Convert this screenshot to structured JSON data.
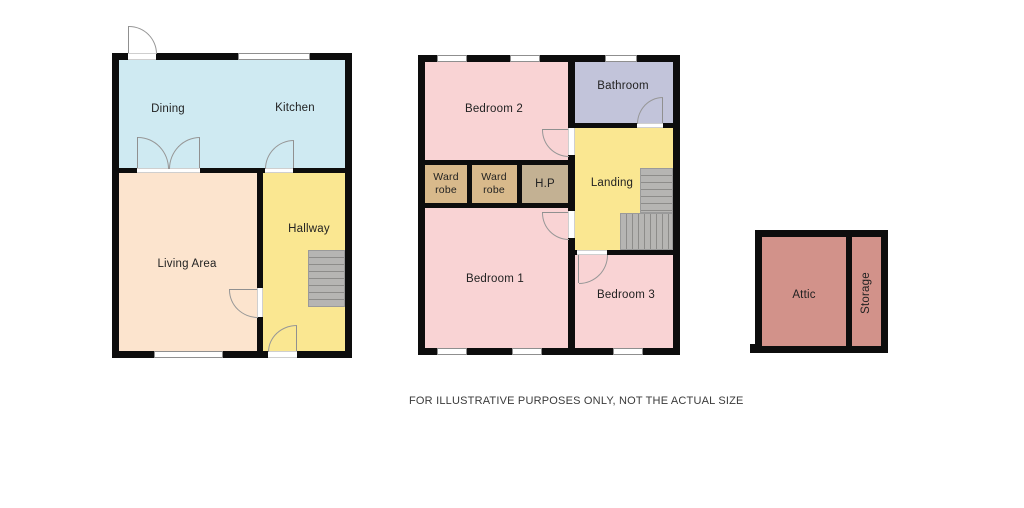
{
  "disclaimer": "FOR ILLUSTRATIVE PURPOSES ONLY, NOT THE ACTUAL SIZE",
  "colors": {
    "wall": "#0d0d0d",
    "dining_kitchen": "#cfeaf2",
    "living": "#fce4ce",
    "hallway": "#fae791",
    "bedroom": "#f9d3d4",
    "bathroom": "#c2c4da",
    "wardrobe": "#d8b98b",
    "hp": "#c3b193",
    "attic": "#d2928a"
  },
  "floors": {
    "ground": {
      "rooms": {
        "dining": "Dining",
        "kitchen": "Kitchen",
        "living": "Living Area",
        "hallway": "Hallway"
      }
    },
    "first": {
      "rooms": {
        "bedroom2": "Bedroom 2",
        "bathroom": "Bathroom",
        "wardrobe1": "Ward robe",
        "wardrobe2": "Ward robe",
        "hp": "H.P",
        "landing": "Landing",
        "bedroom1": "Bedroom 1",
        "bedroom3": "Bedroom 3"
      }
    },
    "attic": {
      "rooms": {
        "attic": "Attic",
        "storage": "Storage"
      }
    }
  }
}
